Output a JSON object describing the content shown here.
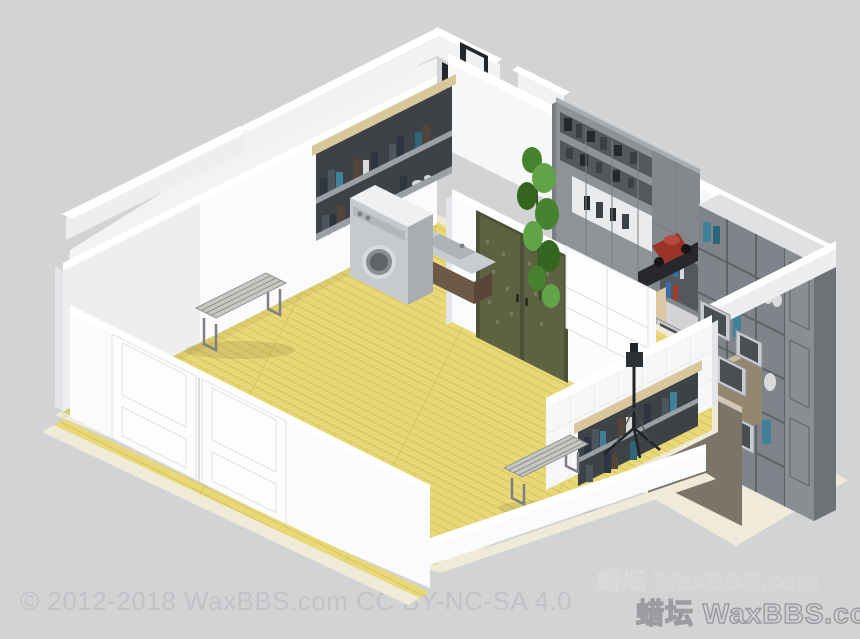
{
  "canvas": {
    "width": 860,
    "height": 639,
    "background": "#d2d3d5"
  },
  "watermarks": {
    "copyright_text": "© 2012-2018 WaxBBS.com CC BY-NC-SA 4.0",
    "brand_text_upper": "蜡坛 WaxBBS.com",
    "brand_text_lower": "蜡坛 WaxBBS.com"
  },
  "scene": {
    "type": "isometric-apartment-floorplan-render",
    "objects": [
      "entry-corridor",
      "doorway-openings",
      "refrigerator",
      "back-wall",
      "gray-wall-unit",
      "hanging-plant",
      "red-scooter-on-desk",
      "cream-floor",
      "cube-bookcase",
      "picture-frames",
      "leaning-board",
      "yellow-plank-floor",
      "ornate-double-door",
      "sliding-panel",
      "tiled-wall",
      "wall-bookshelf-right",
      "tripod-stand",
      "northwest-wall",
      "wall-bookshelf-left",
      "sink-vanity",
      "washing-machine",
      "slatted-bench-left",
      "slatted-bench-right",
      "white-double-doors",
      "low-front-walls"
    ]
  },
  "palette": {
    "bg": "#d2d3d5",
    "wm_gray": "#c2c3c6",
    "wm_light": "#d8d9db",
    "wm_dark": "#9b9c9f",
    "floor": "#e9d877",
    "floor_line": "#d8c45f",
    "cream": "#f0ebd8",
    "wall_top": "#ffffff",
    "wall_face": "#f6f7f9",
    "wall_face2": "#fafbfc",
    "wall_dim": "#eceef0",
    "wall_dim2": "#f1f2f4",
    "wall_side": "#e3e5e8",
    "room_pale": "#f2f3f5",
    "tile": "#e9ebee",
    "shadow": "rgba(0,0,0,0.05)",
    "shadow2": "rgba(0,0,0,0.09)",
    "door_dark": "#24272a",
    "door_leaf": "#eef0f2",
    "fridge_front": "#ebedef",
    "fridge_side": "#dbdde0",
    "white": "#fdfdfe",
    "unit_face": "#8f9397",
    "unit_top": "#a9adb1",
    "unit_edge": "#7b7f83",
    "unit_int": "#54585c",
    "unit_mid": "#3c4045",
    "unit_dark": "#26292c",
    "display": "#e9ebed",
    "unit_panel": "#84888c",
    "book_red": "#a23b2c",
    "book_blue": "#3a6ea8",
    "plant1": "#47822f",
    "plant2": "#63a348",
    "plant3": "#35661f",
    "plant_stem": "#2d4d1c",
    "desk_dark": "#26282b",
    "red_obj": "#9a3327",
    "red_hi": "#b5493a",
    "wheel_dark": "#141617",
    "cube_top": "#dfe1e3",
    "cube_side": "#6e7276",
    "cube_face": "#80848a",
    "cube_line": "#5f6367",
    "cube_panel": "#8a8e92",
    "book_teal": "#3f8198",
    "book_teal2": "#2f6579",
    "white_item": "#d8dadc",
    "book_navy": "#2c3540",
    "book_slate": "#4d565e",
    "book_brown": "#54443a",
    "wood": "#d8c69c",
    "wood2": "#d9c8a2",
    "cab_tan": "#95866f",
    "cab_tan_top": "#c9ba9d",
    "frame_light": "#c9cccf",
    "frame_edge": "#8d9194",
    "frame_dark": "#4b4f54",
    "board": "#7d7468",
    "board_top": "#cfc6b8",
    "olive_frame": "#4c5036",
    "olive": "#5e6243",
    "olive_lt": "#787c52",
    "handle_dark": "#2b2e1f",
    "door_seam": "#dde1e4",
    "door_gap": "#cfd3d6",
    "shelf_int": "#3e4247",
    "shelf_metal": "#9aa0a5",
    "drawer": "#70757a",
    "tripod": "#212427",
    "tripod_dark": "#2e3134",
    "tripod_hi": "#4a4e52",
    "bench_top": "#c6c8c3",
    "bench_edge": "#8f928d",
    "bench_leg": "#7d8084",
    "washer_top": "#eef0f2",
    "washer_front": "#c7cacd",
    "washer_side": "#a9adb1",
    "washer_panel": "#b3b6ba",
    "knob": "#7e8287",
    "drum_ring": "#d8dadd",
    "drum_mid": "#888d91",
    "drum_dark": "#5f6468",
    "sink_brown": "#6d5947",
    "sink_brown_dk": "#594637",
    "sink_top": "#c8ccd0",
    "basin": "#aeb3b7"
  }
}
